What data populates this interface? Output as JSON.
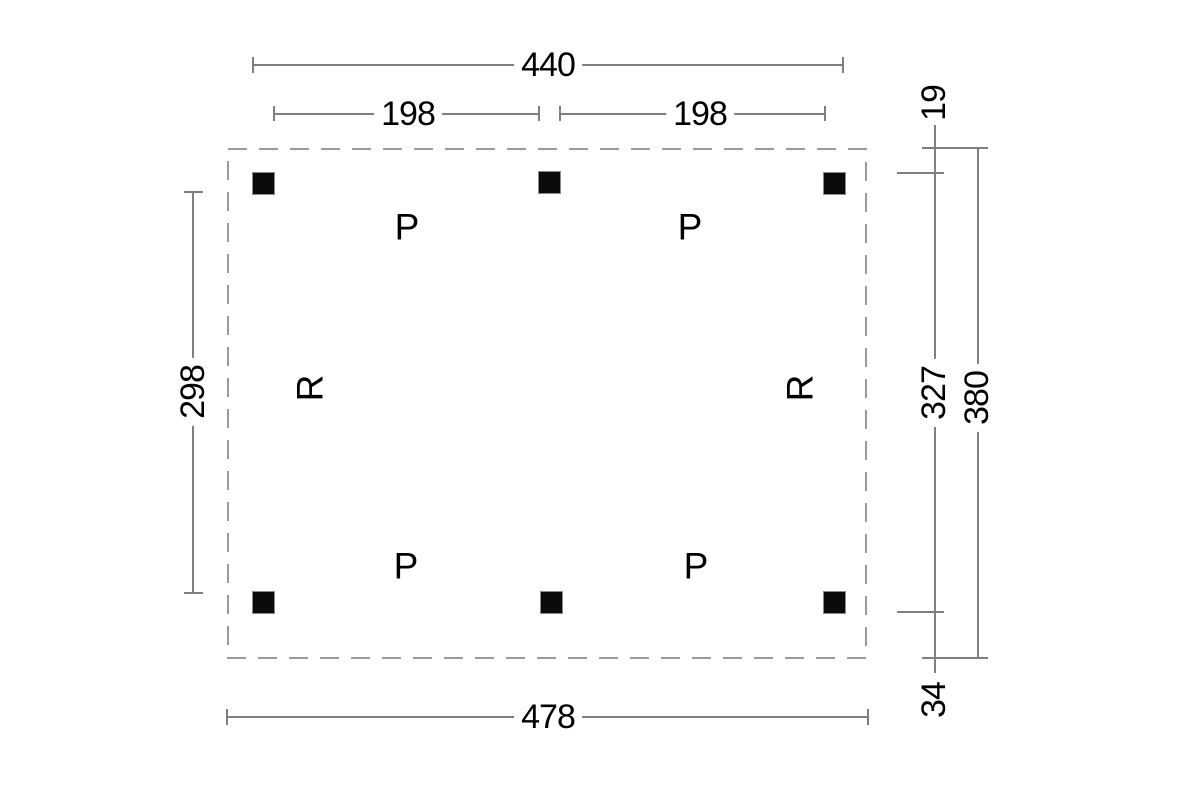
{
  "plan": {
    "post_marker": "P",
    "beam_marker": "R"
  },
  "dimensions": {
    "posts_width_overall": "440",
    "bay_left": "198",
    "bay_right": "198",
    "posts_depth_clear": "298",
    "front_overhang": "19",
    "posts_depth_overall": "327",
    "depth_overall": "380",
    "back_overhang": "34",
    "width_overall": "478"
  },
  "colors": {
    "line": "#7f7f7f",
    "outline_dash": "#9a9a9a",
    "text": "#000000",
    "post": "#0b0b0b",
    "background": "#ffffff"
  }
}
